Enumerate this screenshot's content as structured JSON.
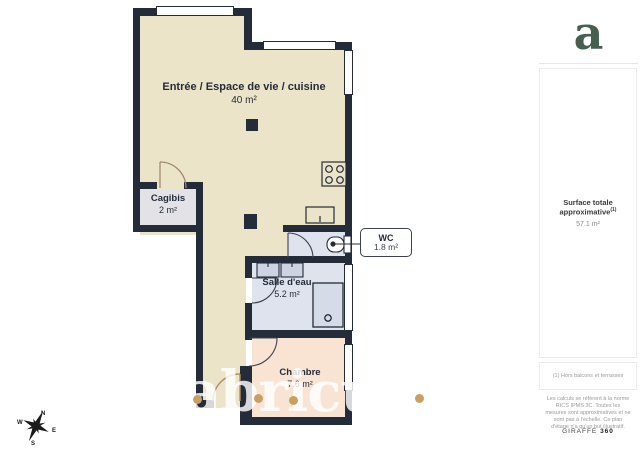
{
  "plan": {
    "rooms": [
      {
        "name": "Entrée / Espace de vie / cuisine",
        "area": "40 m²"
      },
      {
        "name": "Cagibis",
        "area": "2 m²"
      },
      {
        "name": "WC",
        "area": "1.8 m²"
      },
      {
        "name": "Salle d'eau",
        "area": "5.2 m²"
      },
      {
        "name": "Chambre",
        "area": "7.6 m²"
      }
    ],
    "watermark": "abricult",
    "compass": {
      "n": "N",
      "e": "E",
      "s": "S",
      "w": "W"
    }
  },
  "sidebar": {
    "logo_letter": "a",
    "surface_label": "Surface totale approximative",
    "surface_sup": "(1)",
    "surface_value": "57.1 m²",
    "footnote1": "(1) Hors balcons et terrasses",
    "legal": "Les calculs se réfèrent à la norme RICS IPMS 3C. Toutes les mesures sont approximatives et ne sont pas à l'échelle. Ce plan d'étage n'a qu'un but illustratif.",
    "brand": "GIRAFFE",
    "brand_suffix": "360"
  },
  "colors": {
    "wall": "#242b39",
    "floor_main": "#ece4c9",
    "floor_wet": "#dfe3ee",
    "floor_bedroom": "#f9e4d3",
    "floor_storage": "#e3e3e7",
    "accent_tan": "#c9a063",
    "logo_green": "#45604f"
  }
}
